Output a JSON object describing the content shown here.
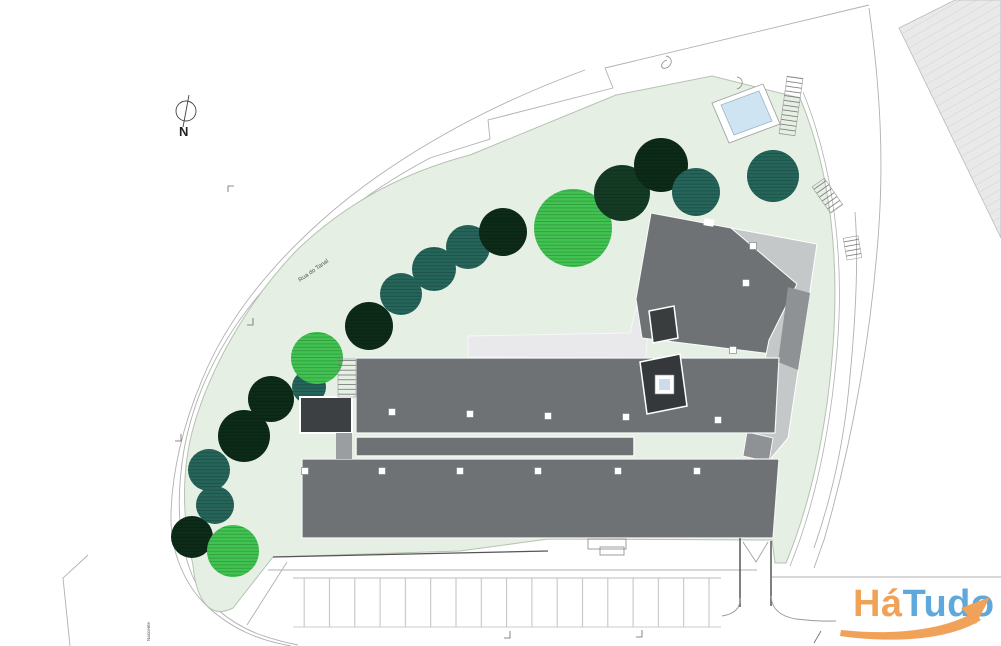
{
  "plan": {
    "north_label": "N",
    "road_label": "Rua do Tanal",
    "side_label": "Nascente"
  },
  "logo": {
    "part1": "Há",
    "part2": "Tudo",
    "orange": "#EFA258",
    "blue": "#5FA8DC"
  },
  "palette": {
    "lawn": "#e6efe3",
    "lawn_edge": "#b5c2b2",
    "tree_darkest": "#0d2b19",
    "tree_dark": "#143c25",
    "tree_teal": "#25655a",
    "tree_bright": "#41c351",
    "building_gray": "#6f7274",
    "building_charcoal": "#3a3d3f",
    "building_light": "#c5c8c9",
    "building_mid": "#8f9294",
    "walkway": "#e9e9ec",
    "pool_water": "#cfe4f2",
    "neighbor_fill": "#e9e9e9",
    "line_gray": "#b0b0b0",
    "wall_dark": "#555555"
  },
  "trees": [
    {
      "x": 192,
      "y": 537,
      "r": 21,
      "color": "tree_darkest"
    },
    {
      "x": 233,
      "y": 551,
      "r": 26,
      "color": "tree_bright"
    },
    {
      "x": 209,
      "y": 470,
      "r": 21,
      "color": "tree_teal"
    },
    {
      "x": 215,
      "y": 505,
      "r": 19,
      "color": "tree_teal"
    },
    {
      "x": 244,
      "y": 436,
      "r": 26,
      "color": "tree_darkest"
    },
    {
      "x": 271,
      "y": 399,
      "r": 23,
      "color": "tree_darkest"
    },
    {
      "x": 309,
      "y": 387,
      "r": 17,
      "color": "tree_teal"
    },
    {
      "x": 317,
      "y": 358,
      "r": 26,
      "color": "tree_bright"
    },
    {
      "x": 369,
      "y": 326,
      "r": 24,
      "color": "tree_darkest"
    },
    {
      "x": 401,
      "y": 294,
      "r": 21,
      "color": "tree_teal"
    },
    {
      "x": 434,
      "y": 269,
      "r": 22,
      "color": "tree_teal"
    },
    {
      "x": 468,
      "y": 247,
      "r": 22,
      "color": "tree_teal"
    },
    {
      "x": 503,
      "y": 232,
      "r": 24,
      "color": "tree_darkest"
    },
    {
      "x": 573,
      "y": 228,
      "r": 39,
      "color": "tree_bright"
    },
    {
      "x": 622,
      "y": 193,
      "r": 28,
      "color": "tree_dark"
    },
    {
      "x": 661,
      "y": 165,
      "r": 27,
      "color": "tree_darkest"
    },
    {
      "x": 696,
      "y": 192,
      "r": 24,
      "color": "tree_teal"
    },
    {
      "x": 773,
      "y": 176,
      "r": 26,
      "color": "tree_teal"
    }
  ],
  "roof_vents": [
    {
      "x": 392,
      "y": 412
    },
    {
      "x": 470,
      "y": 414
    },
    {
      "x": 548,
      "y": 416
    },
    {
      "x": 626,
      "y": 417
    },
    {
      "x": 718,
      "y": 420
    },
    {
      "x": 305,
      "y": 471
    },
    {
      "x": 382,
      "y": 471
    },
    {
      "x": 460,
      "y": 471
    },
    {
      "x": 538,
      "y": 471
    },
    {
      "x": 618,
      "y": 471
    },
    {
      "x": 697,
      "y": 471
    },
    {
      "x": 753,
      "y": 246
    },
    {
      "x": 746,
      "y": 283
    },
    {
      "x": 733,
      "y": 350
    }
  ]
}
